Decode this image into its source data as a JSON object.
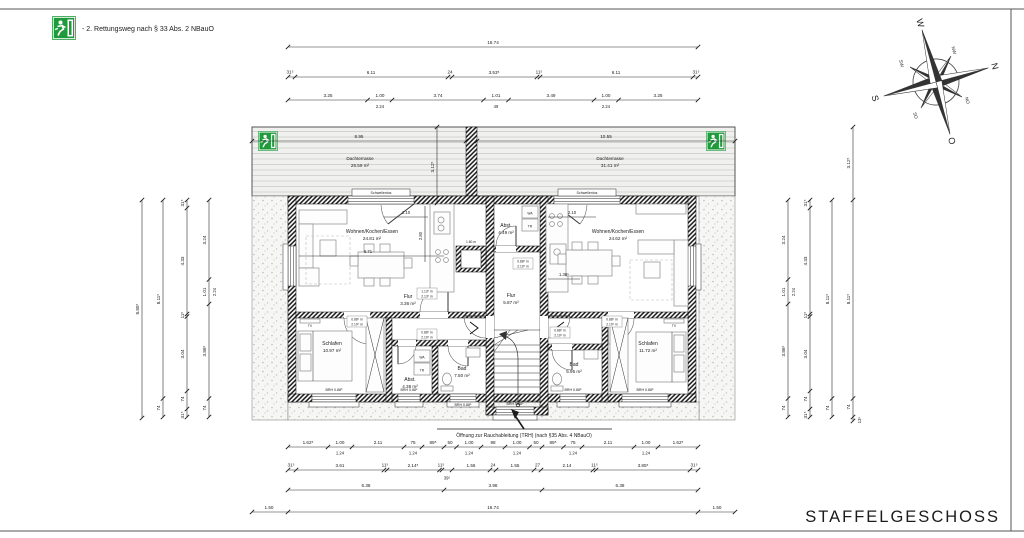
{
  "page": {
    "title": "STAFFELGESCHOSS"
  },
  "legend": {
    "note": "- 2. Rettungsweg nach § 33 Abs. 2 NBauO"
  },
  "compass": {
    "n": "N",
    "e": "O",
    "s": "S",
    "w": "W",
    "ne": "NO",
    "se": "SO",
    "sw": "SW",
    "nw": "NW"
  },
  "colors": {
    "exit_green": "#219a3d",
    "line": "#1b1b1b"
  },
  "terrace": {
    "left_name": "Dachterrasse",
    "left_area": "26.59 m²",
    "right_name": "Dachterrasse",
    "right_area": "31.41 m²",
    "left_width": "8.95",
    "right_width": "10.55",
    "depth": "3.12⁵",
    "threshold": "Schwellenlos"
  },
  "rooms": {
    "living_left": {
      "name": "Wohnen/Kochen/Essen",
      "area": "24.81 m²"
    },
    "living_right": {
      "name": "Wohnen/Kochen/Essen",
      "area": "24.62 m²"
    },
    "sleep_left": {
      "name": "Schlafen",
      "area": "10.97 m²"
    },
    "sleep_right": {
      "name": "Schlafen",
      "area": "11.72 m²"
    },
    "bath_left": {
      "name": "Bad",
      "area": "7.50 m²"
    },
    "bath_right": {
      "name": "Bad",
      "area": "5.95 m²"
    },
    "hall_left": {
      "name": "Flur",
      "area": "3.36 m²"
    },
    "hall_right": {
      "name": "Flur",
      "area": "5.87 m²"
    },
    "storage_left": {
      "name": "Abst.",
      "area": "4.38 m²"
    },
    "storage_center": {
      "name": "Abst.",
      "area": "4.49 m²"
    }
  },
  "annotations": {
    "smoke_vent": "Öffnung zur Rauchableitung (TRH) (nach §35 Abs. 4 NBauO)",
    "brh": "BRH 0.88⁵",
    "door_w": "0.88⁵ m",
    "door_h": "2.10⁵ m",
    "door2_w": "1.13⁵ m",
    "door2_h": "2.13⁵ m",
    "wa": "WA",
    "tr": "TR",
    "tv": "TV",
    "dim_210": "2.10",
    "dim_671": "6.71",
    "dim_280": "2.80",
    "dim_160": "1.60 m",
    "dim_136": "1.36⁵"
  },
  "dims": {
    "top_total": "16.74",
    "top_row2": [
      "31⁵",
      "6.11",
      "24",
      "3.53⁵",
      "11⁵",
      "6.11",
      "31⁵"
    ],
    "top_row3": [
      "3.25",
      "1.00",
      "3.74",
      "1.01",
      "3.49",
      "1.00",
      "3.25"
    ],
    "top_row3_sub": [
      "2.24",
      "49",
      "2.24"
    ],
    "bottom_row1": [
      "1.62⁵",
      "1.00",
      "2.11",
      "75",
      "89⁵",
      "50",
      "1.00",
      "98",
      "1.00",
      "50",
      "89⁵",
      "75",
      "2.11",
      "1.00",
      "1.62⁵"
    ],
    "bottom_row1_sub": "1.24",
    "bottom_row2": [
      "31⁵",
      "3.61",
      "11⁵",
      "2.14⁵",
      "11⁵",
      "39⁵",
      "1.56",
      "24",
      "1.55",
      "27",
      "2.14",
      "11⁵",
      "3.85⁵",
      "31⁵"
    ],
    "bottom_row3": [
      "6.38",
      "3.98",
      "6.38"
    ],
    "bottom_row4": [
      "1.50",
      "16.74",
      "1.50"
    ],
    "left_col1": "8.85⁵",
    "left_col2": [
      "8.11⁵",
      "74"
    ],
    "left_col3": [
      "31⁵",
      "4.33",
      "11⁵",
      "3.04",
      "74",
      "31⁵"
    ],
    "left_col4": [
      "3.24",
      "1.01",
      "2.24",
      "3.86⁵",
      "74"
    ],
    "right_col1": [
      "3.24",
      "1.01",
      "2.24",
      "3.86⁵",
      "74"
    ],
    "right_col2": [
      "31⁵",
      "4.33",
      "11⁵",
      "3.04",
      "74",
      "31⁵"
    ],
    "right_col3": [
      "8.11⁵",
      "74"
    ],
    "right_col4": [
      "3.12⁵",
      "8.11⁵",
      "74",
      "13⁵"
    ]
  }
}
